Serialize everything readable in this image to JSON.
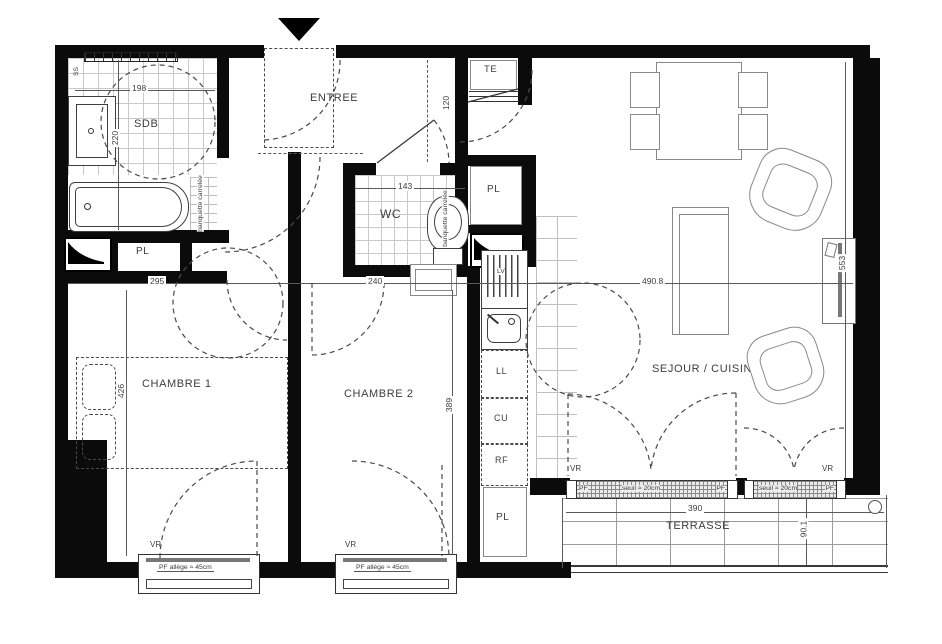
{
  "meta": {
    "drawing_type": "apartment floor plan"
  },
  "rooms": {
    "entree": "ENTREE",
    "sdb": "SDB",
    "wc": "WC",
    "chambre1": "CHAMBRE 1",
    "chambre2": "CHAMBRE 2",
    "sejour_cuisine": "SEJOUR / CUISINE",
    "terrasse": "TERRASSE"
  },
  "storage": {
    "closet": "PL"
  },
  "fixtures": {
    "towel_rail": "SS",
    "electrical_panel": "TE",
    "dishwasher": "LV",
    "washing_machine": "LL",
    "cooktop": "CU",
    "fridge": "RF",
    "toilet_ref": "D110",
    "tiled_bench": "banquette carrelée"
  },
  "dimensions": {
    "sdb_width": "198",
    "sdb_depth": "220",
    "entry_niche": "120",
    "wc_width": "143",
    "chambre1_width": "295",
    "chambre2_width": "240",
    "sejour_width": "490.8",
    "sejour_depth": "553",
    "chambre1_depth": "426",
    "chambre2_depth": "389",
    "terrasse_width": "390",
    "terrasse_depth": "90.1"
  },
  "annotations": {
    "roller_shutter": "VR",
    "window_tag": "PF",
    "threshold": "seuil ≈ 20cm",
    "sill_height": "PF allège ≈ 45cm"
  },
  "colors": {
    "wall": "#0b0b0b",
    "line": "#4a4a4a",
    "tile": "#c9c9c9"
  }
}
